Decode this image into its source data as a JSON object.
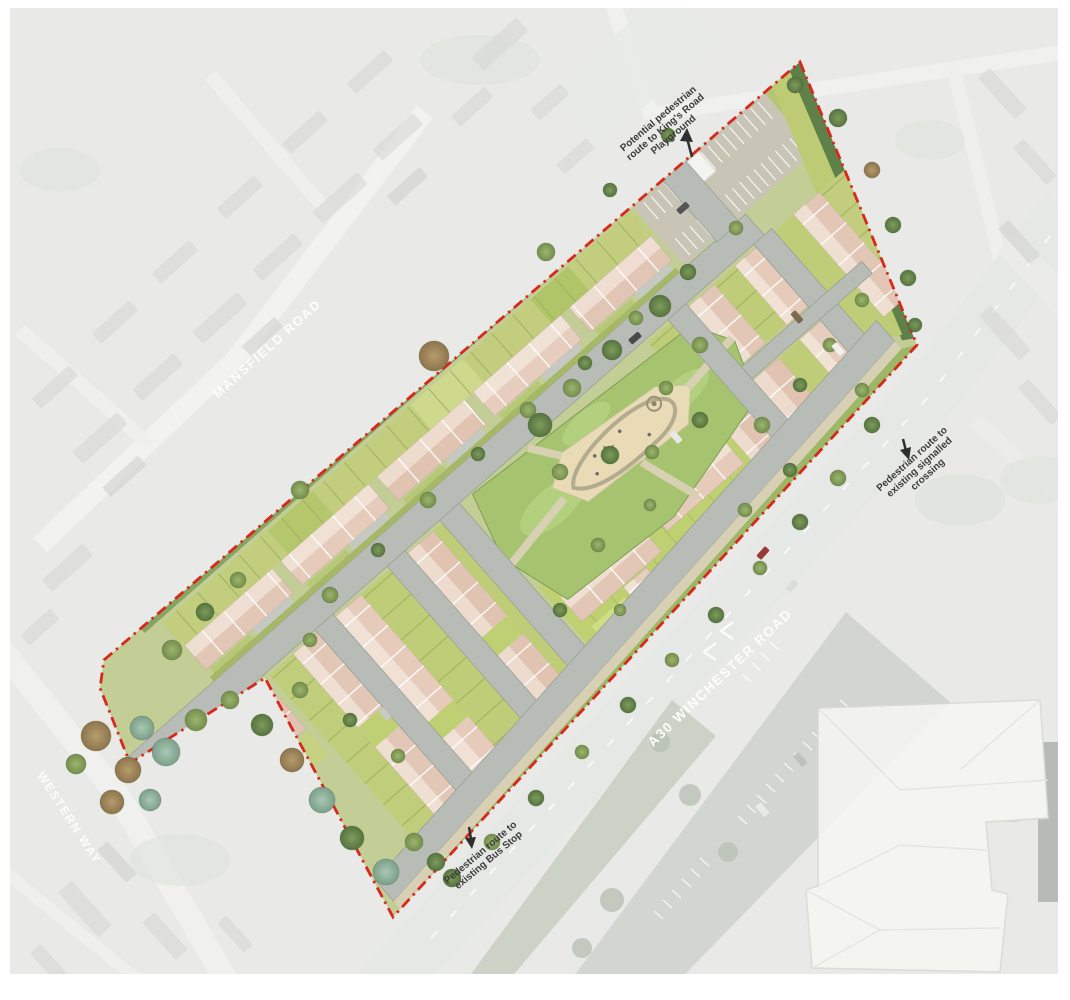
{
  "map": {
    "title": "Residential development site masterplan over aerial photograph",
    "road_labels": {
      "mansfield": "MANSFIELD ROAD",
      "winchester": "A30 WINCHESTER ROAD",
      "western": "WESTERN WAY"
    },
    "annotations": {
      "playground_route": {
        "lines": [
          "Potential pedestrian",
          "route to King's Road",
          "Playground"
        ]
      },
      "crossing_route": {
        "lines": [
          "Pedestrian route to",
          "existing signalled",
          "crossing"
        ]
      },
      "bus_stop_route": {
        "lines": [
          "Pedestrian route to",
          "existing Bus Stop"
        ]
      }
    },
    "palette": {
      "boundary_red": "#d8281b",
      "roof_tan": "#e3c7b6",
      "roof_light": "#efdfd2",
      "garden_green": "#c2ce7d",
      "grass_green": "#a6c46f",
      "road_grey": "#b8bcb6",
      "playground_sand": "#e8dbb5",
      "aerial_grey": "#d9dad6",
      "annotation_text": "#3b3b3b",
      "road_label_text": "#fdfdfa"
    }
  }
}
